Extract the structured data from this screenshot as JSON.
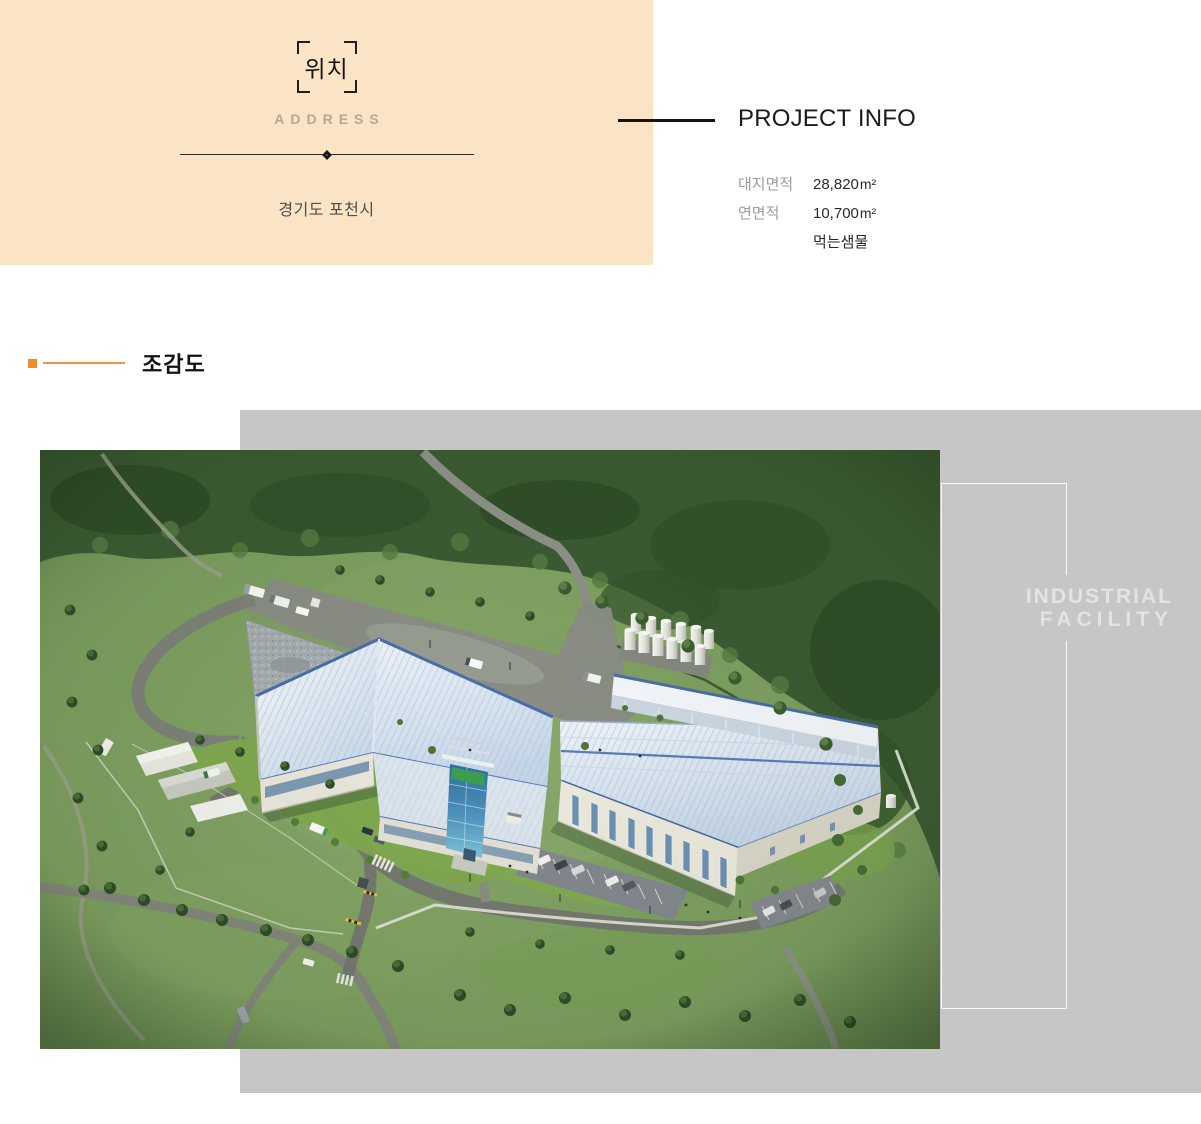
{
  "address_block": {
    "title": "위치",
    "subtitle": "ADDRESS",
    "location": "경기도 포천시"
  },
  "project_info": {
    "title": "PROJECT INFO",
    "rows": [
      {
        "label": "대지면적",
        "value": "28,820",
        "unit": "m²"
      },
      {
        "label": "연면적",
        "value": "10,700",
        "unit": "m²"
      },
      {
        "label": "",
        "value": "먹는샘물",
        "unit": ""
      }
    ]
  },
  "section": {
    "title": "조감도"
  },
  "overlay": {
    "line1": "INDUSTRIAL",
    "line2": "FACILITY"
  },
  "colors": {
    "accent_peach": "#fbe3c6",
    "accent_orange": "#ee8d2a",
    "panel_gray": "#c6c6c6",
    "overlay_text": "#e3e3e3",
    "heading_dark": "#161616"
  }
}
